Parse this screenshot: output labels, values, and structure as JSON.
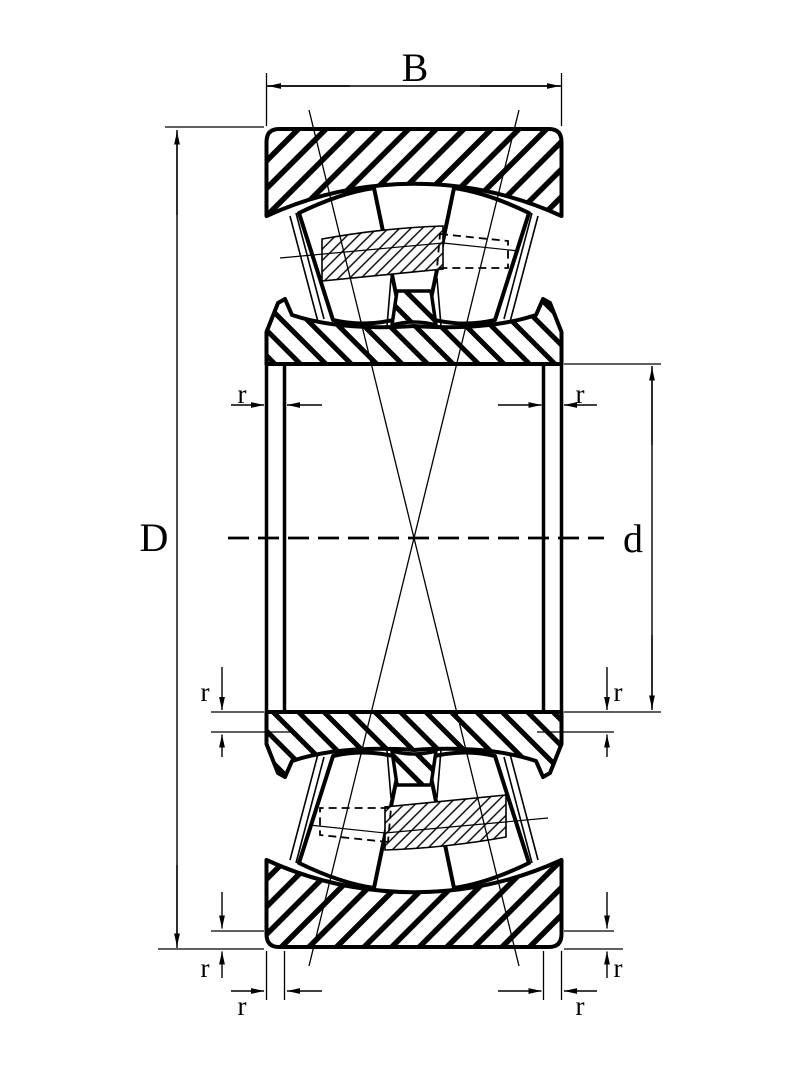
{
  "drawing": {
    "title": "spherical-roller-bearing-cross-section",
    "labels": {
      "width": "B",
      "outer_diameter": "D",
      "bore_diameter": "d",
      "chamfer": "r"
    },
    "chamfer_label_count": 8,
    "line_color": "#000000",
    "background_color": "#ffffff"
  }
}
